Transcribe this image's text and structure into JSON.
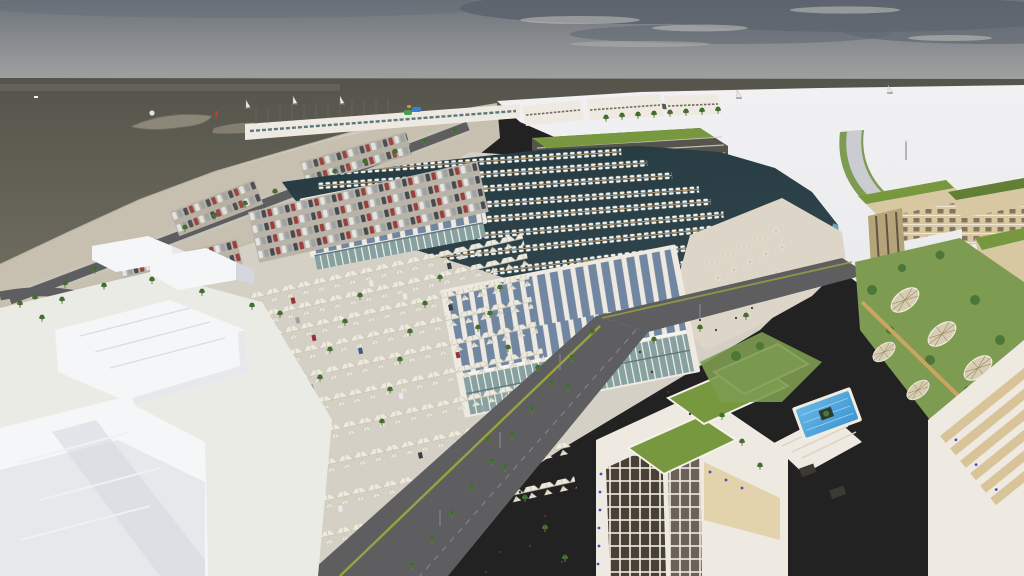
{
  "scene": {
    "type": "3d-architectural-rendering",
    "caption": "Aerial rendering of a coastal marina development with boat showrooms, shaded parking, beachfront hotel and residential blocks",
    "labels": {
      "sky": "overcast gray sky with dark clouds",
      "sea": "open sea, dark olive-gray water",
      "jetty": "curved rocky breakwater jetty",
      "harbor_entrance": "harbor entrance breakwater with red beacon",
      "sailboats": "small sailboats near the horizon",
      "plain": "undeveloped white terrain",
      "beach_sand": "sandy shoreline strip",
      "coastal_road": "palm-lined coastal road",
      "waterfront_strip": "row of waterfront commercial buildings with boat masts",
      "water_park": "colorful water-park slides",
      "hotel": "beachfront hotel with green roof",
      "event_hall": "curved-roof event hall",
      "ramp": "elevated highway access ramp",
      "marina": "marina basin with piers and moored boats",
      "lagoon_beach": "lagoon beach with umbrellas and loungers",
      "showroom_a": "boat showroom A with sawtooth solar roof",
      "showroom_b": "boat showroom B with sawtooth solar roof and glass facade",
      "shaded_parking": "parking rows under white tensile canopies with palms",
      "open_parking": "open-air parking rows with cars",
      "boulevard": "main boulevard with palm rows",
      "plaza": "pedestrian plaza with palms",
      "massing": "white conceptual massing buildings",
      "apartments": "beige apartment blocks with green roofs",
      "garden": "courtyard garden with lattice shade domes",
      "tower": "foreground residential building with green roofs and dark glazing",
      "pool": "blue swimming pool with island planter",
      "people": "pedestrians on the promenade"
    }
  },
  "colors": {
    "sky-top": "#6e747c",
    "sky-cloud-dark": "#59616c",
    "sky-mid": "#8f9194",
    "sky-low": "#a7a9a7",
    "cloud-light": "#bcbdb8",
    "sea-deep": "#55544b",
    "sea-left": "#6d6b5e",
    "sea-right": "#4d4e49",
    "foam": "#cfc8b6",
    "sand-beach": "#c7c0b1",
    "sand-light": "#ddd6c8",
    "plain-white": "#f1f1f3",
    "plain-low": "#e6e7ea",
    "ground-concrete": "#d5d0c5",
    "marina-deep": "#263a41",
    "marina-water": "#31464e",
    "lagoon-aqua": "#6fbecf",
    "pier-tan": "#b2976f",
    "boat-white": "#f2f4f2",
    "bldg-white": "#eeeae1",
    "glass-green": "#87a1a0",
    "glass-dark": "#5d787e",
    "solar-blue": "#7186a1",
    "green-roof": "#78983f",
    "green-roof-dark": "#617f35",
    "lawn-green": "#7d9b51",
    "tree-green": "#4d7738",
    "palm-green": "#3f6b2f",
    "palm-trunk": "#8a6f4d",
    "beige-wall": "#d8c8a1",
    "beige-shadow": "#b5a479",
    "window-dark": "#4a4136",
    "road-asphalt": "#5e5e60",
    "road-dark": "#4a4a4c",
    "sidewalk": "#c8c3b7",
    "median-green": "#9aa23e",
    "canopy-white": "#edeadd",
    "canopy-shade": "#c9c4b4",
    "pool-blue": "#3e96d2",
    "pool-light": "#66b6e6",
    "massing-top": "#f5f6f8",
    "massing-side": "#e6e8ec",
    "massing-shade": "#d4d7de",
    "ramp-gray": "#caccd1",
    "dome-tan": "#d8cdb2",
    "lattice": "#998c6c",
    "hotel-dark": "#55534a",
    "hotel-line": "#cfd2c8",
    "sign-blue": "#3f6fc0",
    "slide-green": "#46a04a",
    "slide-blue": "#3f7fd0",
    "slide-orange": "#e08a30",
    "car-white": "#e8e9ea",
    "car-gray": "#9aa0a4",
    "car-dark": "#3a3f46",
    "car-red": "#973333",
    "pot-blue": "#4e46c6",
    "people-dark": "#3c3a36",
    "gold-walk": "#c9a55f"
  }
}
